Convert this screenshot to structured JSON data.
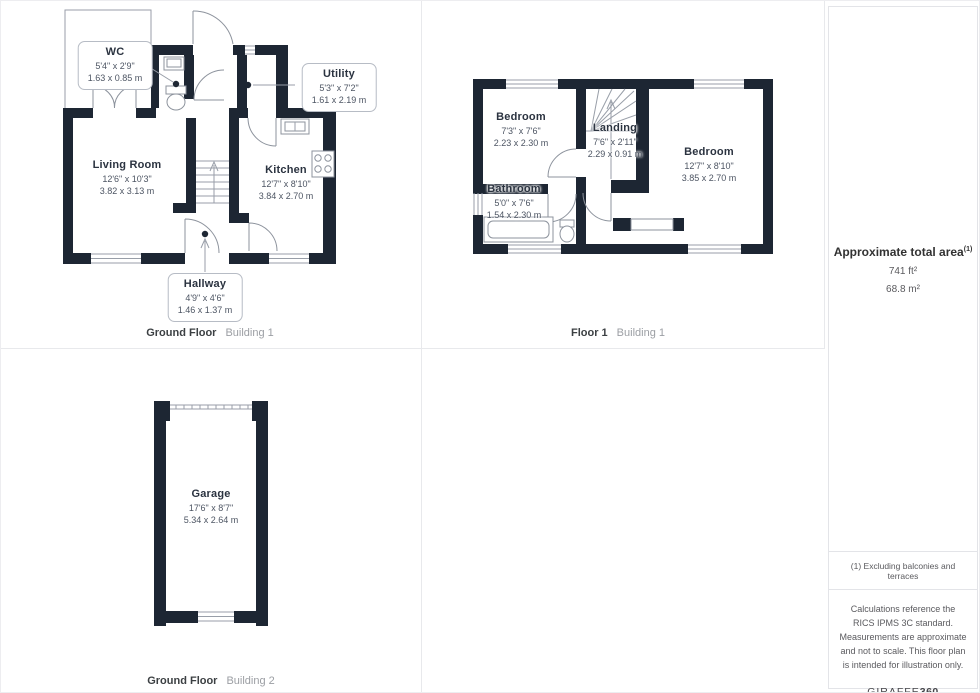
{
  "colors": {
    "wall": "#1d2633",
    "line": "#989ea8",
    "text_dark": "#2b3340",
    "text_dim": "#4d5563"
  },
  "plans": {
    "gf1": {
      "caption": {
        "label": "Ground Floor",
        "building": "Building 1"
      },
      "rooms": {
        "wc": {
          "name": "WC",
          "imperial": "5'4\" x 2'9\"",
          "metric": "1.63 x 0.85 m"
        },
        "utility": {
          "name": "Utility",
          "imperial": "5'3\" x 7'2\"",
          "metric": "1.61 x 2.19 m"
        },
        "living": {
          "name": "Living Room",
          "imperial": "12'6\" x 10'3\"",
          "metric": "3.82 x 3.13 m"
        },
        "kitchen": {
          "name": "Kitchen",
          "imperial": "12'7\" x 8'10\"",
          "metric": "3.84 x 2.70 m"
        },
        "hallway": {
          "name": "Hallway",
          "imperial": "4'9\" x 4'6\"",
          "metric": "1.46 x 1.37 m"
        }
      }
    },
    "f1": {
      "caption": {
        "label": "Floor 1",
        "building": "Building 1"
      },
      "rooms": {
        "bedroom1": {
          "name": "Bedroom",
          "imperial": "7'3\" x 7'6\"",
          "metric": "2.23 x 2.30 m"
        },
        "landing": {
          "name": "Landing",
          "imperial": "7'6\" x 2'11\"",
          "metric": "2.29 x 0.91 m"
        },
        "bedroom2": {
          "name": "Bedroom",
          "imperial": "12'7\" x 8'10\"",
          "metric": "3.85 x 2.70 m"
        },
        "bathroom": {
          "name": "Bathroom",
          "imperial": "5'0\" x 7'6\"",
          "metric": "1.54 x 2.30 m"
        }
      }
    },
    "gf2": {
      "caption": {
        "label": "Ground Floor",
        "building": "Building 2"
      },
      "rooms": {
        "garage": {
          "name": "Garage",
          "imperial": "17'6\" x 8'7\"",
          "metric": "5.34 x 2.64 m"
        }
      }
    }
  },
  "sidebar": {
    "area_title": "Approximate total area",
    "area_sup": "(1)",
    "area_imperial": "741 ft²",
    "area_metric": "68.8 m²",
    "note1": "(1) Excluding balconies and terraces",
    "disclaimer": "Calculations reference the RICS IPMS 3C standard. Measurements are approximate and not to scale. This floor plan is intended for illustration only.",
    "brand_regular": "GIRAFFE",
    "brand_bold": "360"
  }
}
